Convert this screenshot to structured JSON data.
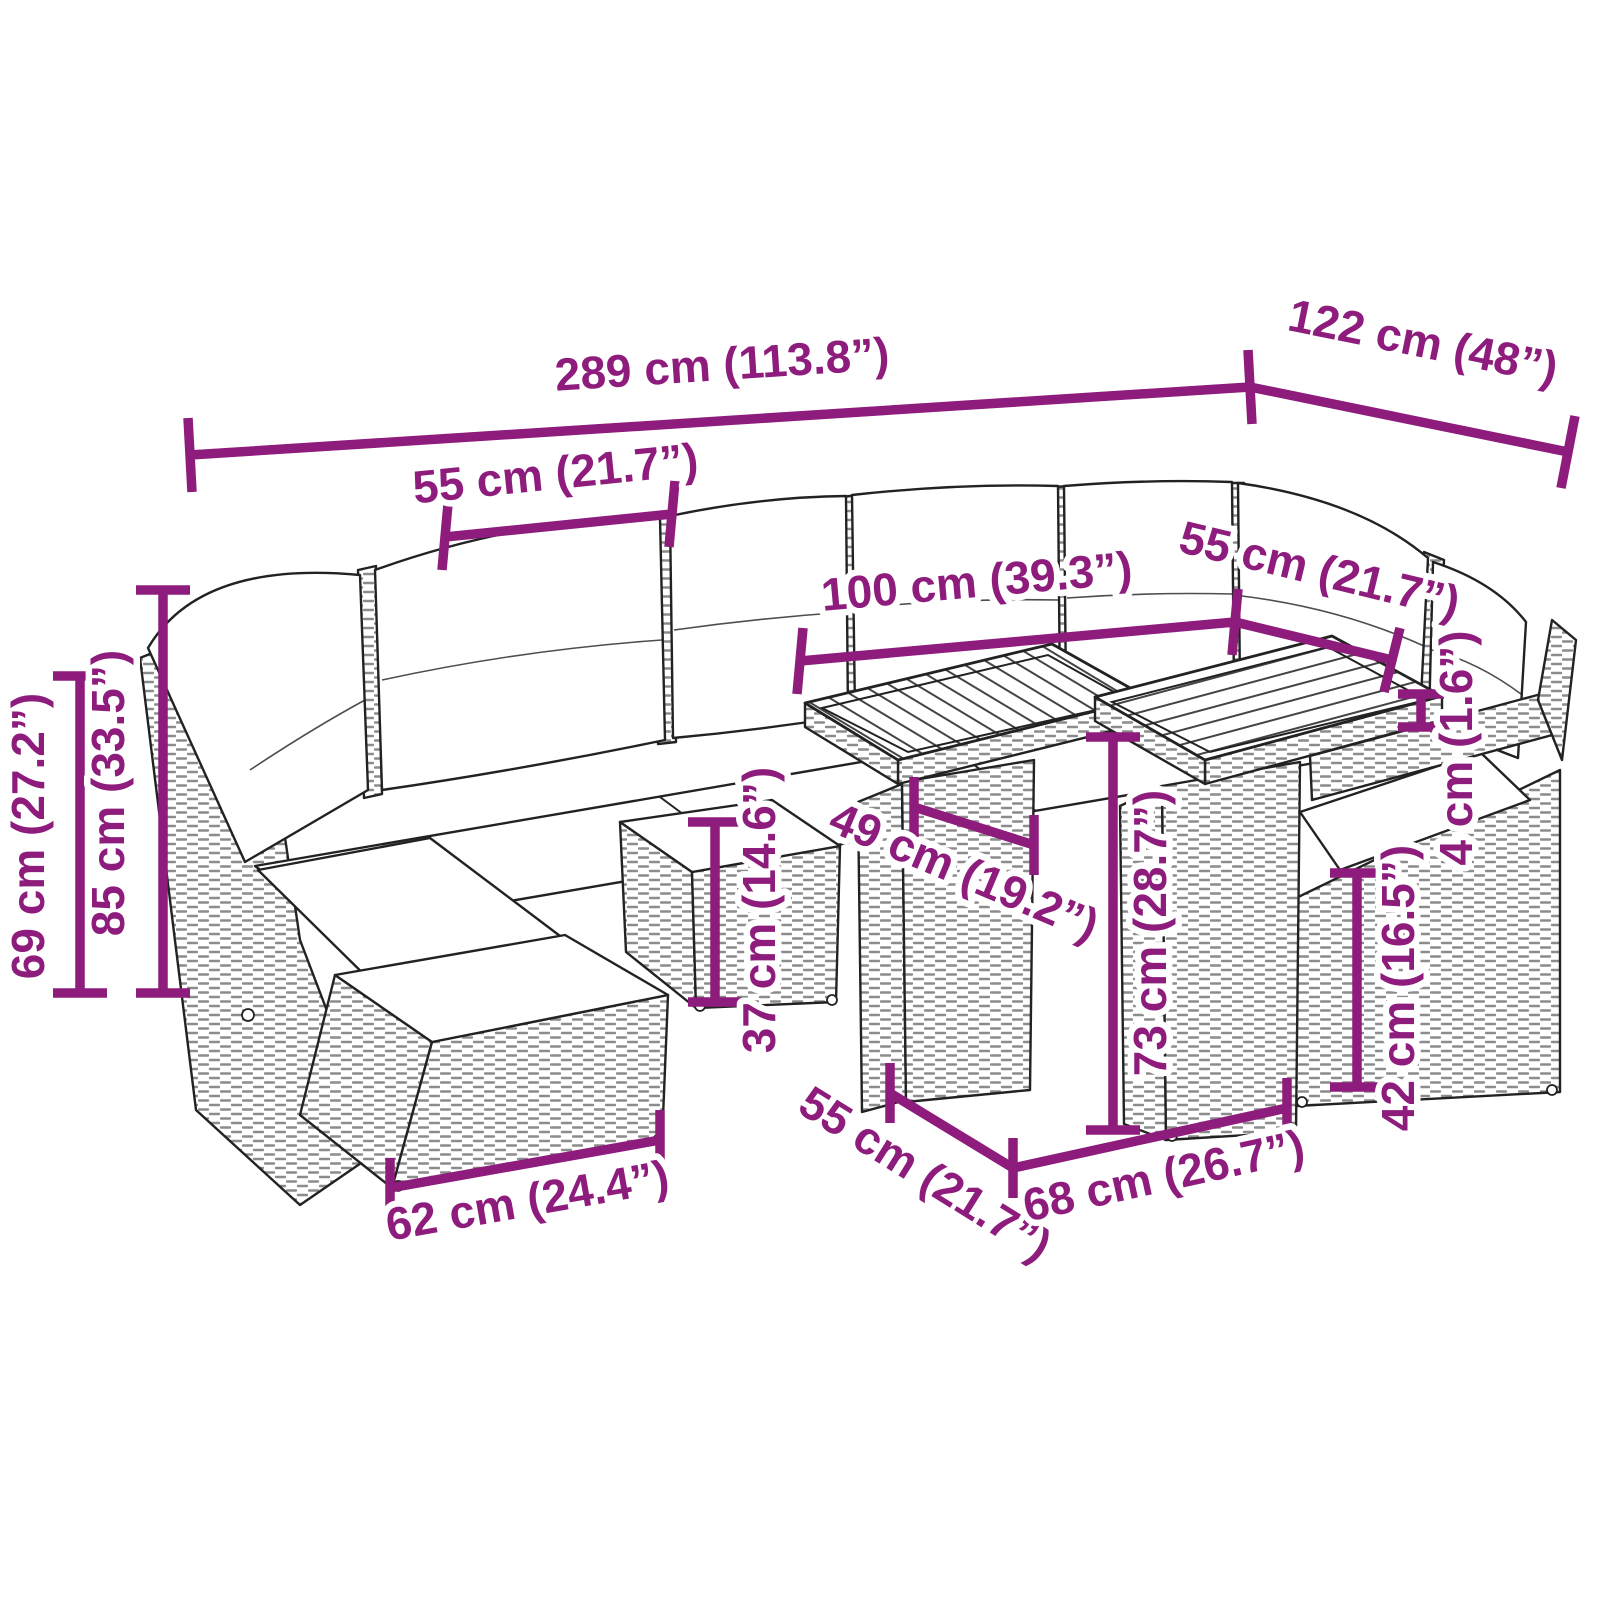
{
  "illustration": {
    "alt": "Black-and-white line drawing of a rattan garden lounge set: L-shaped corner sofa with white cushions, two square tables with slatted wood tops, a footstool and an armrest chair, annotated with purple dimension lines"
  },
  "colors": {
    "dimension": "#8e1c7c",
    "line_art": "#222222",
    "rattan_texture": "#8c8c8c",
    "cushion_fill": "#ffffff",
    "background": "#ffffff"
  },
  "dimensions": [
    {
      "name": "overall-width",
      "cm": 289,
      "inch": "113.8",
      "label": "289 cm (113.8”)"
    },
    {
      "name": "overall-depth",
      "cm": 122,
      "inch": "48",
      "label": "122 cm (48”)"
    },
    {
      "name": "left-module-width",
      "cm": 55,
      "inch": "21.7",
      "label": "55 cm (21.7”)"
    },
    {
      "name": "table-group-length",
      "cm": 100,
      "inch": "39.3",
      "label": "100 cm (39.3”)"
    },
    {
      "name": "right-module-width",
      "cm": 55,
      "inch": "21.7",
      "label": "55 cm (21.7”)"
    },
    {
      "name": "back-height",
      "cm": 69,
      "inch": "27.2",
      "label": "69 cm (27.2”)"
    },
    {
      "name": "total-height",
      "cm": 85,
      "inch": "33.5",
      "label": "85 cm (33.5”)"
    },
    {
      "name": "stool-height",
      "cm": 37,
      "inch": "14.6",
      "label": "37 cm (14.6”)"
    },
    {
      "name": "table-top-depth",
      "cm": 49,
      "inch": "19.2",
      "label": "49 cm (19.2”)"
    },
    {
      "name": "table-height",
      "cm": 73,
      "inch": "28.7",
      "label": "73 cm (28.7”)"
    },
    {
      "name": "armrest-thickness",
      "cm": 4,
      "inch": "1.6",
      "label": "4 cm (1.6”)"
    },
    {
      "name": "seat-base-height",
      "cm": 42,
      "inch": "16.5",
      "label": "42 cm (16.5”)"
    },
    {
      "name": "ottoman-width",
      "cm": 62,
      "inch": "24.4",
      "label": "62 cm (24.4”)"
    },
    {
      "name": "table-width",
      "cm": 55,
      "inch": "21.7",
      "label": "55 cm (21.7”)"
    },
    {
      "name": "table-length",
      "cm": 68,
      "inch": "26.7",
      "label": "68 cm (26.7”)"
    }
  ]
}
